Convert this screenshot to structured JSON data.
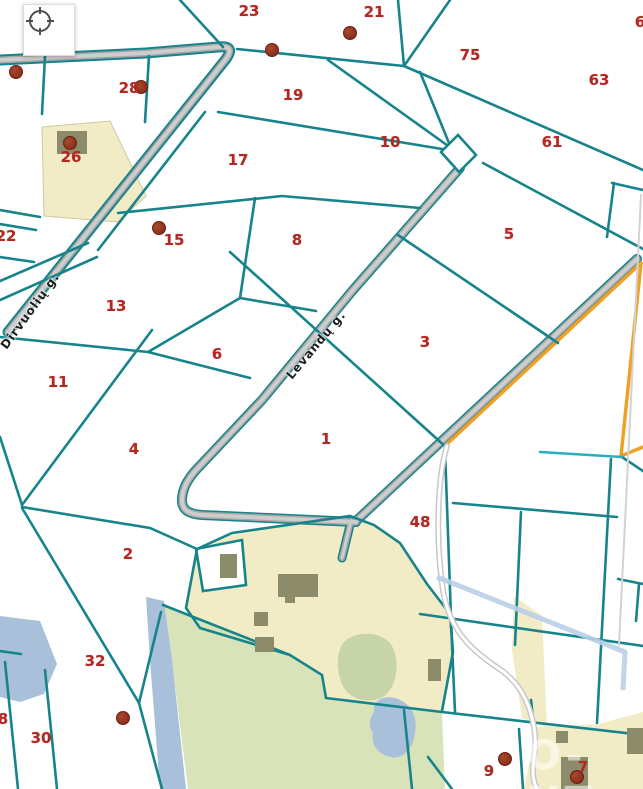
{
  "map": {
    "controls": {
      "locate_button": {
        "icon": "crosshair-icon"
      }
    },
    "street_labels": [
      {
        "text": "Dirvuolių g.",
        "x": 30,
        "y": 311,
        "angle": -54
      },
      {
        "text": "Levandų g.",
        "x": 316,
        "y": 345,
        "angle": -50
      }
    ],
    "parcel_numbers": [
      {
        "label": "23",
        "x": 249,
        "y": 11
      },
      {
        "label": "21",
        "x": 374,
        "y": 12
      },
      {
        "label": "6",
        "x": 640,
        "y": 22
      },
      {
        "label": "75",
        "x": 470,
        "y": 55
      },
      {
        "label": "63",
        "x": 599,
        "y": 80
      },
      {
        "label": "28",
        "x": 129,
        "y": 88
      },
      {
        "label": "19",
        "x": 293,
        "y": 95
      },
      {
        "label": "10",
        "x": 390,
        "y": 142
      },
      {
        "label": "61",
        "x": 552,
        "y": 142
      },
      {
        "label": "26",
        "x": 71,
        "y": 157
      },
      {
        "label": "17",
        "x": 238,
        "y": 160
      },
      {
        "label": "22",
        "x": 6,
        "y": 236
      },
      {
        "label": "15",
        "x": 174,
        "y": 240
      },
      {
        "label": "8",
        "x": 297,
        "y": 240
      },
      {
        "label": "5",
        "x": 509,
        "y": 234
      },
      {
        "label": "13",
        "x": 116,
        "y": 306
      },
      {
        "label": "3",
        "x": 425,
        "y": 342
      },
      {
        "label": "6",
        "x": 217,
        "y": 354
      },
      {
        "label": "11",
        "x": 58,
        "y": 382
      },
      {
        "label": "1",
        "x": 326,
        "y": 439
      },
      {
        "label": "4",
        "x": 134,
        "y": 449
      },
      {
        "label": "48",
        "x": 420,
        "y": 522
      },
      {
        "label": "2",
        "x": 128,
        "y": 554
      },
      {
        "label": "32",
        "x": 95,
        "y": 661
      },
      {
        "label": "30",
        "x": 41,
        "y": 738
      },
      {
        "label": "8",
        "x": 3,
        "y": 719
      },
      {
        "label": "9",
        "x": 489,
        "y": 771
      },
      {
        "label": "7",
        "x": 583,
        "y": 767
      }
    ],
    "markers": [
      {
        "x": 16,
        "y": 72
      },
      {
        "x": 272,
        "y": 50
      },
      {
        "x": 350,
        "y": 33
      },
      {
        "x": 141,
        "y": 87
      },
      {
        "x": 70,
        "y": 143
      },
      {
        "x": 159,
        "y": 228
      },
      {
        "x": 123,
        "y": 718
      },
      {
        "x": 505,
        "y": 759
      },
      {
        "x": 577,
        "y": 777
      }
    ],
    "watermark": {
      "text": "O-NT",
      "x": 527,
      "y": 733
    },
    "colors": {
      "parcel_line": "#16848a",
      "parcel_line_bright": "#29aebc",
      "parcel_number": "#b32822",
      "marker": "#8d2f1c",
      "road_fill": "#c9c9c9",
      "road_edge": "#a6a6a6",
      "built_area": "#f1ecc6",
      "forest": "#d9e3ba",
      "forest_dark": "#c7d4a9",
      "water": "#a9c0db",
      "orange_boundary": "#f0a125",
      "powerline": "#b9cfe8",
      "building": "#8c8b6a"
    }
  }
}
